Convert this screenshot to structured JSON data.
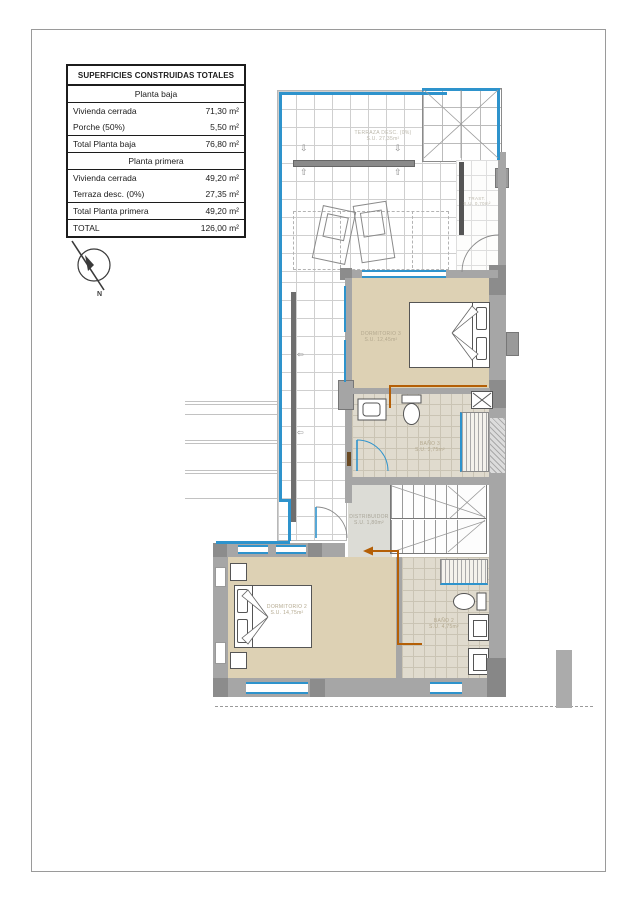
{
  "table": {
    "title": "SUPERFICIES CONSTRUIDAS TOTALES",
    "planta_baja": {
      "header": "Planta baja",
      "rows": [
        {
          "label": "Vivienda cerrada",
          "value": "71,30 m²"
        },
        {
          "label": "Porche (50%)",
          "value": "5,50 m²"
        }
      ],
      "total": {
        "label": "Total Planta baja",
        "value": "76,80 m²"
      }
    },
    "planta_primera": {
      "header": "Planta primera",
      "rows": [
        {
          "label": "Vivienda cerrada",
          "value": "49,20 m²"
        },
        {
          "label": "Terraza desc. (0%)",
          "value": "27,35 m²"
        }
      ],
      "total": {
        "label": "Total Planta primera",
        "value": "49,20 m²"
      }
    },
    "grand_total": {
      "label": "TOTAL",
      "value": "126,00 m²"
    }
  },
  "compass": {
    "north_label": "N"
  },
  "rooms": {
    "terraza": {
      "name": "TERRAZA DESC. (0%)",
      "area": "S.U. 27,35m²"
    },
    "trastero": {
      "name": "TRAST.",
      "area": "S.U. 0,70m²"
    },
    "dormitorio3": {
      "name": "DORMITORIO 3",
      "area": "S.U. 12,45m²"
    },
    "bano3": {
      "name": "BAÑO 3",
      "area": "S.U. 3,75m²"
    },
    "distribuidor": {
      "name": "DISTRIBUIDOR",
      "area": "S.U. 1,80m²"
    },
    "dormitorio2": {
      "name": "DORMITORIO 2",
      "area": "S.U. 14,75m²"
    },
    "bano2": {
      "name": "BAÑO 2",
      "area": "S.U. 4,75m²"
    }
  },
  "icons": {
    "arrow_up": "⇧",
    "arrow_down": "⇩",
    "arrow_left": "⇦"
  },
  "colors": {
    "glazing_blue": "#2e93cc",
    "floor_beige": "#ddd1b4",
    "wall_gray": "#a6a6a6",
    "annotation_orange": "#b45f06",
    "tile_line_gray": "#cfcfcf"
  }
}
